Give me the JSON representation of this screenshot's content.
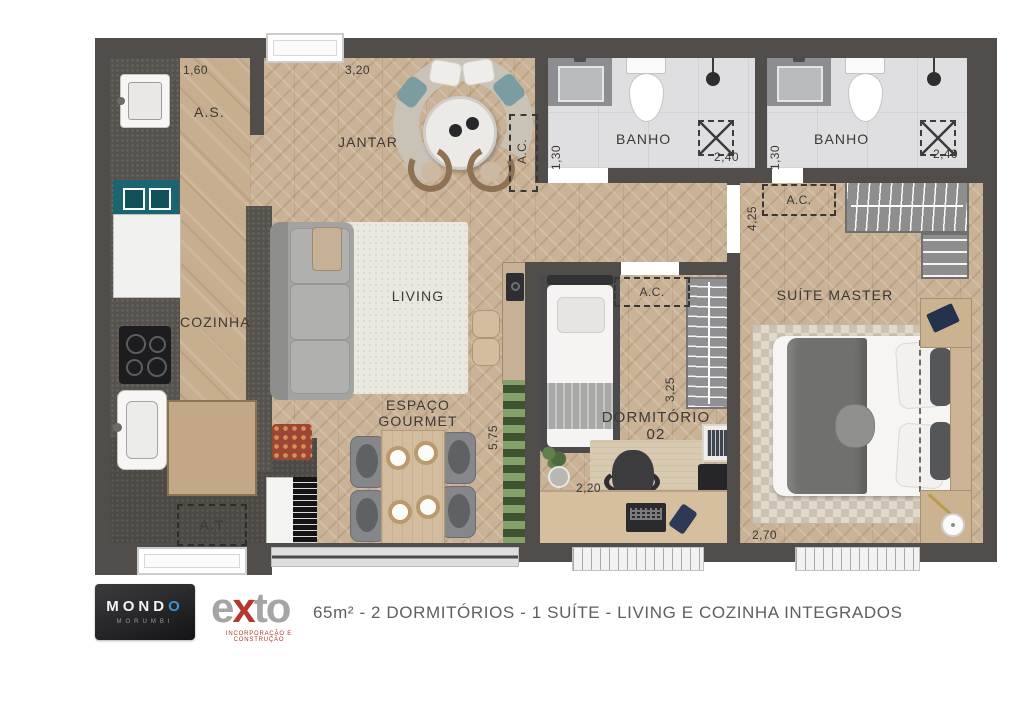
{
  "plan": {
    "labels": {
      "as": "A.S.",
      "jantar": "JANTAR",
      "cozinha": "COZINHA",
      "living": "LIVING",
      "gourmet1": "ESPAÇO",
      "gourmet2": "GOURMET",
      "banho": "BANHO",
      "ac": "A.C.",
      "at": "A.T",
      "dorm_line1": "DORMITÓRIO",
      "dorm_line2": "02",
      "suite": "SUÍTE MASTER"
    },
    "dims": {
      "as_w": "1,60",
      "jantar_w": "3,20",
      "banho_d": "1,30",
      "banho_w": "2,40",
      "hall_d": "4,25",
      "dorm_d": "3,25",
      "dorm_w": "2,20",
      "gourmet_d": "5,75",
      "suite_w": "2,70"
    }
  },
  "footer": {
    "mondo_prefix": "MOND",
    "mondo_o": "O",
    "mondo_sub": "MORUMBI",
    "exto_e": "e",
    "exto_x": "x",
    "exto_to": "to",
    "exto_tagline": "INCORPORAÇÃO E CONSTRUÇÃO",
    "description": "65m² - 2 DORMITÓRIOS - 1 SUÍTE - LIVING E COZINHA INTEGRADOS"
  },
  "colors": {
    "wall": "#514d4b",
    "wood": "#c9b296",
    "tile": "#dfdfe1",
    "granite": "#56524d",
    "teal_appliance": "#1b6570",
    "brand_red": "#b5372c",
    "brand_blue": "#3f8fd2",
    "text": "#3d3935"
  }
}
